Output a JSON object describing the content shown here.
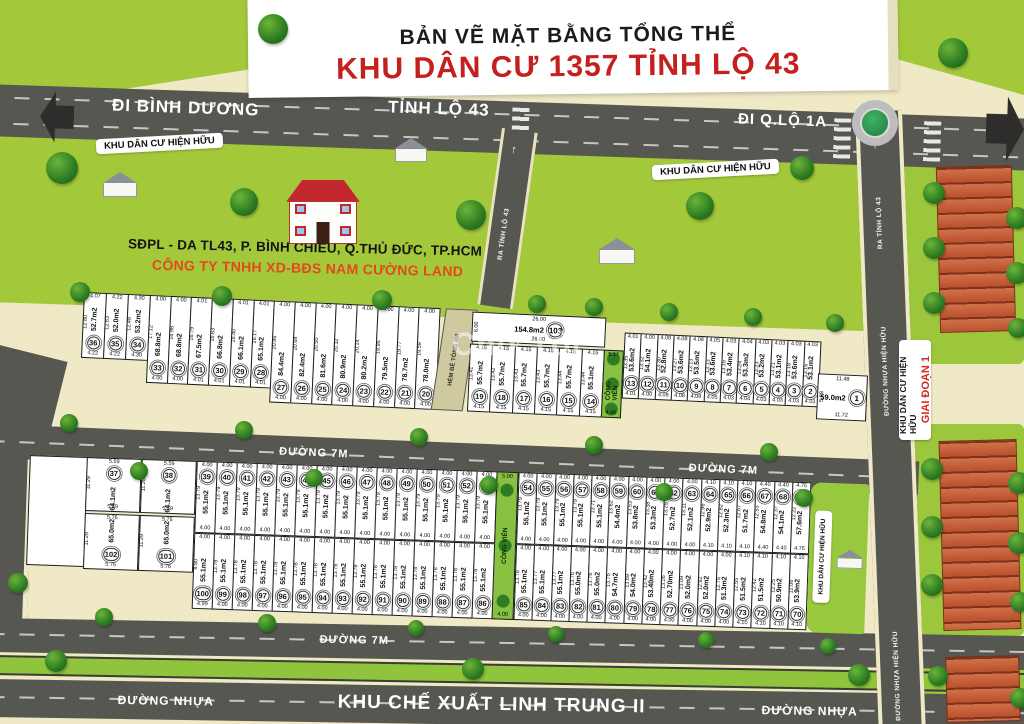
{
  "banner": {
    "line1": "BẢN VẼ MẶT BẰNG TỔNG THỂ",
    "line2": "KHU DÂN CƯ 1357 TỈNH LỘ 43"
  },
  "roads": {
    "di_binh_duong": "ĐI BÌNH DƯƠNG",
    "tinh_lo_43": "TỈNH LỘ 43",
    "di_qlo_1a": "ĐI Q.LỘ 1A",
    "ra_tinh_lo_43": "RA TỈNH LỘ 43",
    "duong_nhua_hien_huu": "ĐƯỜNG NHỰA HIỆN HỮU",
    "hem_be_tong_4m": "HẺM BÊ TÔNG 4M",
    "duong_7m": "ĐƯỜNG 7M",
    "duong_nhua": "ĐƯỜNG NHỰA",
    "khu_che_xuat": "KHU CHẾ XUẤT LINH TRUNG II"
  },
  "labels": {
    "khu_hien_huu": "KHU DÂN CƯ HIỆN HỮU",
    "giai_doan_1": "GIAI ĐOẠN 1",
    "cong_vien": "CÔNG VIÊN",
    "address": "SĐPL - DA TL43, P. BÌNH CHIỂU, Q.THỦ ĐỨC, TP.HCM",
    "company": "CÔNG TY TNHH XD-BĐS NAM CƯỜNG LAND",
    "watermark": "Chợ Tốt"
  },
  "colors": {
    "background": "#EFE9C6",
    "field_green": "#A3C93A",
    "road_gray": "#575752",
    "title_red": "#C5201E",
    "company_red": "#E2491F",
    "plot_white": "#FFFFFF"
  },
  "park_strips": {
    "top": {
      "label": "CÔNG VIÊN",
      "w": "5.17",
      "wb": "4.00"
    },
    "bottom": {
      "label": "CÔNG VIÊN",
      "w": "5.00",
      "wb": "4.00"
    }
  },
  "plots": {
    "top_left": [
      {
        "n": "36",
        "a": "52.7m2",
        "w": "4.07",
        "d": "12.80",
        "wb": "4.22"
      },
      {
        "n": "35",
        "a": "52.0m2",
        "w": "4.22",
        "d": "12.63",
        "wb": "4.22"
      },
      {
        "n": "34",
        "a": "53.2m2",
        "w": "4.30",
        "d": "12.48",
        "wb": "4.30"
      }
    ],
    "top_mid": [
      {
        "n": "33",
        "a": "68.8m2",
        "w": "4.00",
        "d": "17.12"
      },
      {
        "n": "32",
        "a": "68.8m2",
        "w": "4.00",
        "d": "16.98"
      },
      {
        "n": "31",
        "a": "67.5m2",
        "w": "4.01",
        "d": "16.79"
      },
      {
        "n": "30",
        "a": "66.8m2",
        "w": "4.01",
        "d": "16.63"
      },
      {
        "n": "29",
        "a": "66.1m2",
        "w": "4.01",
        "d": "16.40"
      },
      {
        "n": "28",
        "a": "65.1m2",
        "w": "4.01",
        "d": "16.17"
      },
      {
        "n": "27",
        "a": "84.4m2",
        "w": "4.00",
        "d": "20.86"
      },
      {
        "n": "26",
        "a": "82.4m2",
        "w": "4.00",
        "d": "20.68"
      },
      {
        "n": "25",
        "a": "81.6m2",
        "w": "4.00",
        "d": "20.50"
      },
      {
        "n": "24",
        "a": "80.9m2",
        "w": "4.00",
        "d": "20.32"
      },
      {
        "n": "23",
        "a": "80.2m2",
        "w": "4.00",
        "d": "20.14"
      },
      {
        "n": "22",
        "a": "79.5m2",
        "w": "4.00",
        "d": "19.95"
      },
      {
        "n": "21",
        "a": "78.7m2",
        "w": "4.00",
        "d": "19.77"
      },
      {
        "n": "20",
        "a": "78.0m2",
        "w": "4.00",
        "d": "19.59"
      }
    ],
    "lot103": {
      "n": "103",
      "a": "154.8m2",
      "w": "26.00",
      "wb": "26.00",
      "d": "6.00"
    },
    "top_c": [
      {
        "n": "19",
        "a": "55.7m2",
        "w": "4.15",
        "d": "13.41"
      },
      {
        "n": "18",
        "a": "55.7m2",
        "w": "4.15",
        "d": "13.42"
      },
      {
        "n": "17",
        "a": "55.7m2",
        "w": "4.15",
        "d": "13.43"
      },
      {
        "n": "16",
        "a": "55.7m2",
        "w": "4.15",
        "d": "13.43"
      },
      {
        "n": "15",
        "a": "55.7m2",
        "w": "4.15",
        "d": "13.44"
      },
      {
        "n": "14",
        "a": "55.1m2",
        "w": "4.15",
        "d": "13.44"
      }
    ],
    "top_right": [
      {
        "n": "13",
        "a": "53.6m2",
        "w": "4.01",
        "d": "13.35"
      },
      {
        "n": "12",
        "a": "54.1m2",
        "w": "4.00",
        "d": "13.32"
      },
      {
        "n": "11",
        "a": "52.8m2",
        "w": "4.08",
        "d": "13.30"
      },
      {
        "n": "10",
        "a": "53.6m2",
        "w": "4.08",
        "d": "13.27"
      },
      {
        "n": "9",
        "a": "53.5m2",
        "w": "4.08",
        "d": "13.13"
      },
      {
        "n": "8",
        "a": "53.6m2",
        "w": "4.05",
        "d": "13.13"
      },
      {
        "n": "7",
        "a": "53.4m2",
        "w": "4.03",
        "d": "13.16"
      },
      {
        "n": "6",
        "a": "53.3m2",
        "w": "4.04",
        "d": "13.24"
      },
      {
        "n": "5",
        "a": "53.2m2",
        "w": "4.03",
        "d": "13.23"
      },
      {
        "n": "4",
        "a": "53.1m2",
        "w": "4.03",
        "d": "13.21"
      },
      {
        "n": "3",
        "a": "53.6m2",
        "w": "4.03",
        "d": "13.18"
      },
      {
        "n": "2",
        "a": "53.1m2",
        "w": "4.03",
        "d": "13.16"
      }
    ],
    "lot1": {
      "n": "1",
      "a": "59.0m2",
      "w": "11.48",
      "wb": "11.72",
      "d": "5.08"
    },
    "bottom_col": [
      {
        "n": "37",
        "a": "64.1m2",
        "w": "5.59",
        "d": "11.29"
      },
      {
        "n": "38",
        "a": "64.1m2",
        "w": "5.59",
        "d": "11.28"
      },
      {
        "n": "102",
        "a": "65.0m2",
        "w": "5.76",
        "d": "11.29"
      },
      {
        "n": "101",
        "a": "65.0m2",
        "w": "5.76",
        "d": "11.29"
      }
    ],
    "row1_left": [
      {
        "n": "39",
        "a": "55.1m2",
        "w": "4.00",
        "d": "13.79"
      },
      {
        "n": "40",
        "a": "55.1m2",
        "w": "4.00",
        "d": "13.79"
      },
      {
        "n": "41",
        "a": "55.1m2",
        "w": "4.00",
        "d": "13.79"
      },
      {
        "n": "42",
        "a": "55.1m2",
        "w": "4.00",
        "d": "13.79"
      },
      {
        "n": "43",
        "a": "55.1m2",
        "w": "4.00",
        "d": "13.79"
      },
      {
        "n": "44",
        "a": "55.1m2",
        "w": "4.00",
        "d": "13.79"
      },
      {
        "n": "45",
        "a": "55.1m2",
        "w": "4.00",
        "d": "13.79"
      },
      {
        "n": "46",
        "a": "55.1m2",
        "w": "4.00",
        "d": "13.79"
      },
      {
        "n": "47",
        "a": "55.1m2",
        "w": "4.00",
        "d": "13.79"
      },
      {
        "n": "48",
        "a": "55.1m2",
        "w": "4.00",
        "d": "13.79"
      },
      {
        "n": "49",
        "a": "55.1m2",
        "w": "4.00",
        "d": "13.79"
      },
      {
        "n": "50",
        "a": "55.1m2",
        "w": "4.00",
        "d": "13.79"
      },
      {
        "n": "51",
        "a": "55.1m2",
        "w": "4.00",
        "d": "13.79"
      },
      {
        "n": "52",
        "a": "55.1m2",
        "w": "4.00",
        "d": "13.79"
      },
      {
        "n": "53",
        "a": "55.1m2",
        "w": "4.00",
        "d": "13.79"
      }
    ],
    "row1_right": [
      {
        "n": "54",
        "a": "55.1m2",
        "w": "4.00",
        "d": "13.79"
      },
      {
        "n": "55",
        "a": "55.1m2",
        "w": "4.00",
        "d": "13.79"
      },
      {
        "n": "56",
        "a": "55.1m2",
        "w": "4.00",
        "d": "13.79"
      },
      {
        "n": "57",
        "a": "55.1m2",
        "w": "4.00",
        "d": "13.79"
      },
      {
        "n": "58",
        "a": "55.1m2",
        "w": "4.00",
        "d": "13.71"
      },
      {
        "n": "59",
        "a": "54.4m2",
        "w": "4.00",
        "d": "13.62"
      },
      {
        "n": "60",
        "a": "53.8m2",
        "w": "4.00",
        "d": "13.53"
      },
      {
        "n": "61",
        "a": "53.3m2",
        "w": "4.00",
        "d": "13.38"
      },
      {
        "n": "62",
        "a": "52.7m2",
        "w": "4.00",
        "d": "13.25"
      },
      {
        "n": "63",
        "a": "52.1m2",
        "w": "4.00",
        "d": "13.11"
      },
      {
        "n": "64",
        "a": "52.9m2",
        "w": "4.10",
        "d": "12.96"
      },
      {
        "n": "65",
        "a": "52.3m2",
        "w": "4.10",
        "d": "12.82"
      },
      {
        "n": "66",
        "a": "51.7m2",
        "w": "4.10",
        "d": "12.67"
      },
      {
        "n": "67",
        "a": "54.8m2",
        "w": "4.40",
        "d": "12.53"
      },
      {
        "n": "68",
        "a": "54.1m2",
        "w": "4.40",
        "d": "12.37"
      },
      {
        "n": "69",
        "a": "57.6m2",
        "w": "4.75",
        "d": "12.22"
      }
    ],
    "row2_left": [
      {
        "n": "100",
        "a": "55.1m2",
        "w": "4.00",
        "d": "8.80",
        "wb": "4.99"
      },
      {
        "n": "99",
        "a": "55.1m2",
        "w": "4.00",
        "d": "13.78"
      },
      {
        "n": "98",
        "a": "55.1m2",
        "w": "4.00",
        "d": "13.78"
      },
      {
        "n": "97",
        "a": "55.1m2",
        "w": "4.00",
        "d": "13.78"
      },
      {
        "n": "96",
        "a": "55.1m2",
        "w": "4.00",
        "d": "13.78"
      },
      {
        "n": "95",
        "a": "55.1m2",
        "w": "4.00",
        "d": "13.78"
      },
      {
        "n": "94",
        "a": "55.1m2",
        "w": "4.00",
        "d": "13.78"
      },
      {
        "n": "93",
        "a": "55.1m2",
        "w": "4.00",
        "d": "13.78"
      },
      {
        "n": "92",
        "a": "55.1m2",
        "w": "4.00",
        "d": "13.78"
      },
      {
        "n": "91",
        "a": "55.1m2",
        "w": "4.00",
        "d": "13.78"
      },
      {
        "n": "90",
        "a": "55.1m2",
        "w": "4.00",
        "d": "13.78"
      },
      {
        "n": "89",
        "a": "55.1m2",
        "w": "4.00",
        "d": "13.78"
      },
      {
        "n": "88",
        "a": "55.1m2",
        "w": "4.00",
        "d": "13.78"
      },
      {
        "n": "87",
        "a": "55.1m2",
        "w": "4.00",
        "d": "13.78"
      },
      {
        "n": "86",
        "a": "55.1m2",
        "w": "4.00",
        "d": "13.78"
      }
    ],
    "row2_right": [
      {
        "n": "85",
        "a": "55.1m2",
        "w": "4.00",
        "d": "13.78"
      },
      {
        "n": "84",
        "a": "55.1m2",
        "w": "4.00",
        "d": "13.77"
      },
      {
        "n": "83",
        "a": "55.1m2",
        "w": "4.00",
        "d": "13.77"
      },
      {
        "n": "82",
        "a": "55.0m2",
        "w": "4.00",
        "d": "13.76"
      },
      {
        "n": "81",
        "a": "55.0m2",
        "w": "4.00",
        "d": "13.76"
      },
      {
        "n": "80",
        "a": "54.7m2",
        "w": "4.00",
        "d": "13.75"
      },
      {
        "n": "79",
        "a": "54.0m2",
        "w": "4.00",
        "d": "13.69"
      },
      {
        "n": "78",
        "a": "53.40m2",
        "w": "4.00",
        "d": "13.42"
      },
      {
        "n": "77",
        "a": "52.70m2",
        "w": "4.00",
        "d": "13.26"
      },
      {
        "n": "76",
        "a": "52.0m2",
        "w": "4.00",
        "d": "13.09"
      },
      {
        "n": "75",
        "a": "52.0m2",
        "w": "4.00",
        "d": "12.92"
      },
      {
        "n": "74",
        "a": "51.3m2",
        "w": "4.00",
        "d": "12.75"
      },
      {
        "n": "73",
        "a": "51.5m2",
        "w": "4.10",
        "d": "12.55"
      },
      {
        "n": "72",
        "a": "51.5m2",
        "w": "4.10",
        "d": "12.42"
      },
      {
        "n": "71",
        "a": "50.9m2",
        "w": "4.10",
        "d": "12.25"
      },
      {
        "n": "70",
        "a": "53.9m2",
        "w": "4.10",
        "d": "12.08"
      }
    ]
  }
}
